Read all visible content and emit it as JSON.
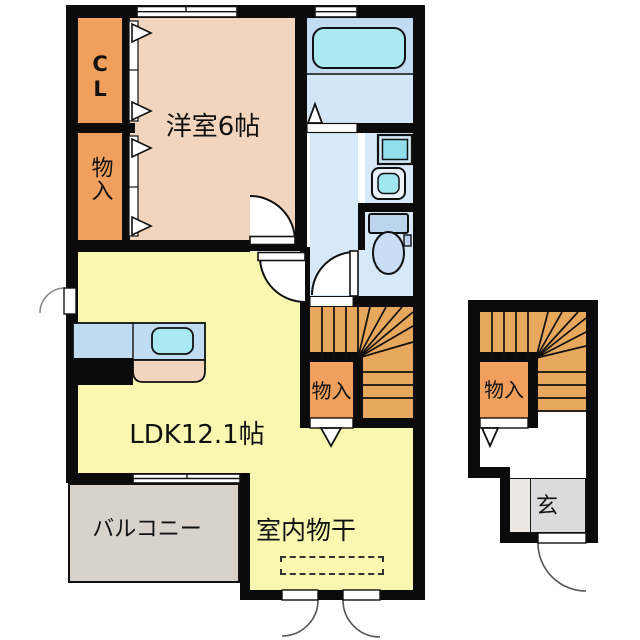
{
  "floorplan": {
    "title": "apartment-floor-plan",
    "rooms": {
      "closet_cl": "CL",
      "closet_upper": "物入",
      "western_room": "洋室6帖",
      "ldk": "LDK12.1帖",
      "balcony": "バルコニー",
      "indoor_laundry": "室内物干",
      "stair_storage": "物入",
      "entry_storage": "物入",
      "entrance": "玄"
    },
    "colors": {
      "wall": "#0b0b0b",
      "closet_orange": "#f0a05c",
      "western_room_peach": "#f2d5bc",
      "ldk_yellow": "#faf7b0",
      "wet_area_blue": "#d7e9f8",
      "tub_zone_blue": "#c0dbf2",
      "fixture_cyan": "#a9e9f2",
      "stairs_tan": "#e7a75c",
      "balcony_gray": "#d9d2ca",
      "entrance_gray": "#dbdbdb"
    }
  }
}
